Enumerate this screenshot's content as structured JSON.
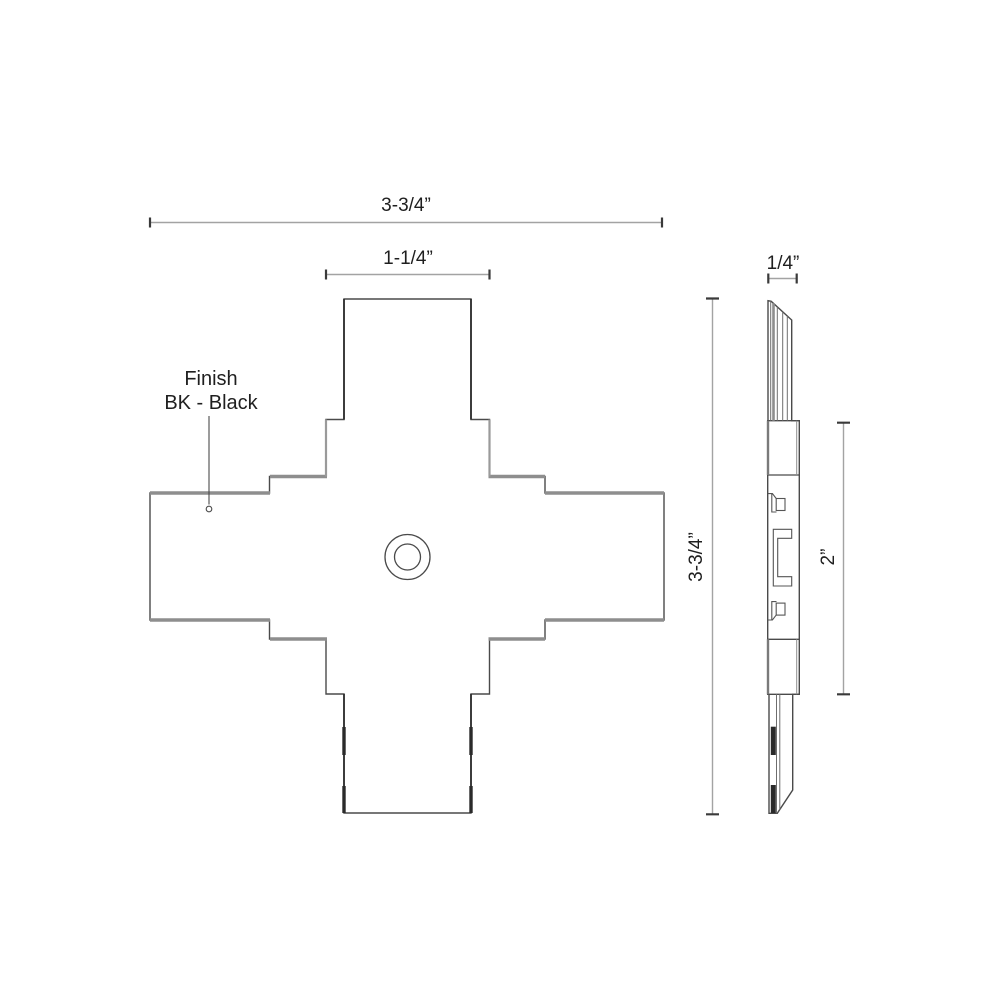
{
  "front_view": {
    "finish_note": {
      "line1": "Finish",
      "line2": "BK - Black"
    },
    "dim_overall_width": "3-3/4”",
    "dim_arm_width": "1-1/4”"
  },
  "side_view": {
    "dim_thickness": "1/4”",
    "dim_overall_height": "3-3/4”",
    "dim_bracket_span": "2”"
  },
  "colors": {
    "background": "#ffffff",
    "outline": "#4a4a4a",
    "thick_edge": "#8e8e8e",
    "dim_line": "#a3a3a3",
    "dim_tick": "#3a3a3a",
    "dark_mark": "#2a2a2a",
    "text": "#1f1f1f"
  }
}
